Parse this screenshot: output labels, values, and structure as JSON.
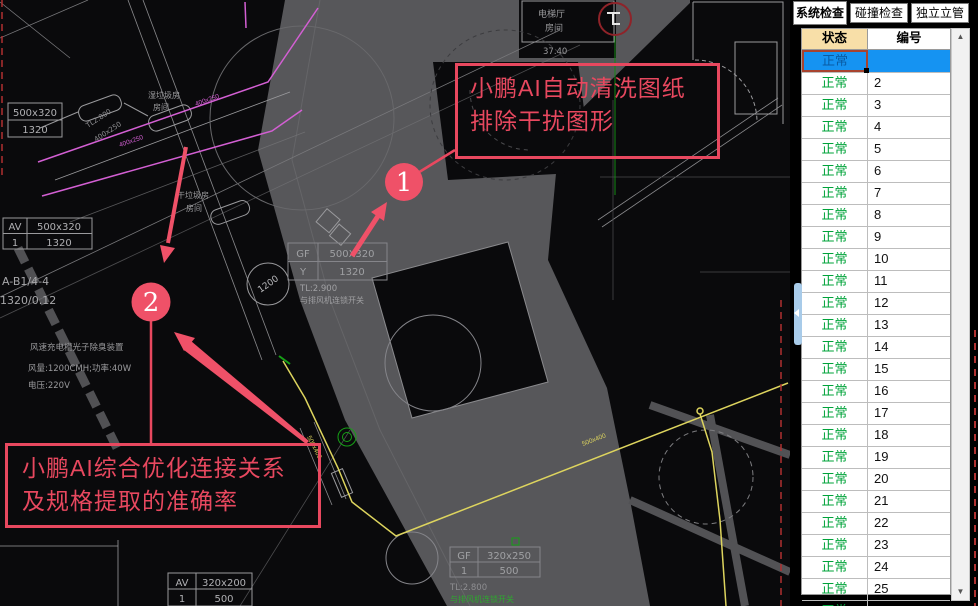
{
  "colors": {
    "annotation_red": "#e8485f",
    "badge_fill": "#ef5168",
    "selected_row_blue": "#1593f2",
    "status_green": "#00a33a",
    "header_tan": "#f8dfa8",
    "band_gray": "#57575a",
    "cad_yellow": "#ddd45e",
    "cad_magenta": "#d35fd3",
    "cad_green": "#16a016",
    "cad_red_dash": "#b03030"
  },
  "annotations": {
    "note1_line1": "小鹏AI自动清洗图纸",
    "note1_line2": "排除干扰图形",
    "badge1": "1",
    "note2_line1": "小鹏AI综合优化连接关系",
    "note2_line2": "及规格提取的准确率",
    "badge2": "2"
  },
  "panel": {
    "tabs": [
      {
        "label": "系统检查",
        "selected": true
      },
      {
        "label": "碰撞检查",
        "selected": false
      },
      {
        "label": "独立立管",
        "selected": false
      }
    ],
    "table": {
      "columns": [
        "状态",
        "编号"
      ],
      "selected_row": {
        "status": "正常",
        "id": ""
      },
      "rows": [
        {
          "status": "正常",
          "id": "2"
        },
        {
          "status": "正常",
          "id": "3"
        },
        {
          "status": "正常",
          "id": "4"
        },
        {
          "status": "正常",
          "id": "5"
        },
        {
          "status": "正常",
          "id": "6"
        },
        {
          "status": "正常",
          "id": "7"
        },
        {
          "status": "正常",
          "id": "8"
        },
        {
          "status": "正常",
          "id": "9"
        },
        {
          "status": "正常",
          "id": "10"
        },
        {
          "status": "正常",
          "id": "11"
        },
        {
          "status": "正常",
          "id": "12"
        },
        {
          "status": "正常",
          "id": "13"
        },
        {
          "status": "正常",
          "id": "14"
        },
        {
          "status": "正常",
          "id": "15"
        },
        {
          "status": "正常",
          "id": "16"
        },
        {
          "status": "正常",
          "id": "17"
        },
        {
          "status": "正常",
          "id": "18"
        },
        {
          "status": "正常",
          "id": "19"
        },
        {
          "status": "正常",
          "id": "20"
        },
        {
          "status": "正常",
          "id": "21"
        },
        {
          "status": "正常",
          "id": "22"
        },
        {
          "status": "正常",
          "id": "23"
        },
        {
          "status": "正常",
          "id": "24"
        },
        {
          "status": "正常",
          "id": "25"
        },
        {
          "status": "正常",
          "id": "26"
        }
      ]
    }
  },
  "drawing": {
    "labels": {
      "room1a": "湿垃圾房",
      "room1b": "房间",
      "room2a": "干垃圾房",
      "room2b": "房间",
      "elev1": "电梯厅",
      "elev2": "房间",
      "level": "37.40",
      "axis1": "A-B1/4-4",
      "axis2": "1320/0.12",
      "device1": "风速充电槽光子除臭装置",
      "device2": "风量:1200CMH;功率:40W",
      "device3": "电压:220V",
      "tl29": "TL:2.900",
      "fan_link1": "与排风机连锁开关",
      "tl28": "TL:2.800",
      "fan_link2": "与排风机连锁开关",
      "duct_dim1": "TL2.800",
      "duct_dim2": "400x250",
      "mag_dim1": "400x250",
      "mag_dim2": "400x250",
      "circle_dim": "1200",
      "yellow_dim1": "500x400",
      "yellow_dim2": "500x400"
    },
    "tables": {
      "t1": {
        "r0c0": "500x320",
        "r1c0": "1320"
      },
      "t2": {
        "r0c0": "AV",
        "r0c1": "500x320",
        "r1c0": "1",
        "r1c1": "1320"
      },
      "t3": {
        "r0c0": "GF",
        "r0c1": "500X320",
        "r1c0": "Y",
        "r1c1": "1320"
      },
      "t4": {
        "r0c0": "GF",
        "r0c1": "320x250",
        "r1c0": "1",
        "r1c1": "500"
      },
      "t5": {
        "r0c0": "AV",
        "r0c1": "320x200",
        "r1c0": "1",
        "r1c1": "500"
      }
    }
  }
}
